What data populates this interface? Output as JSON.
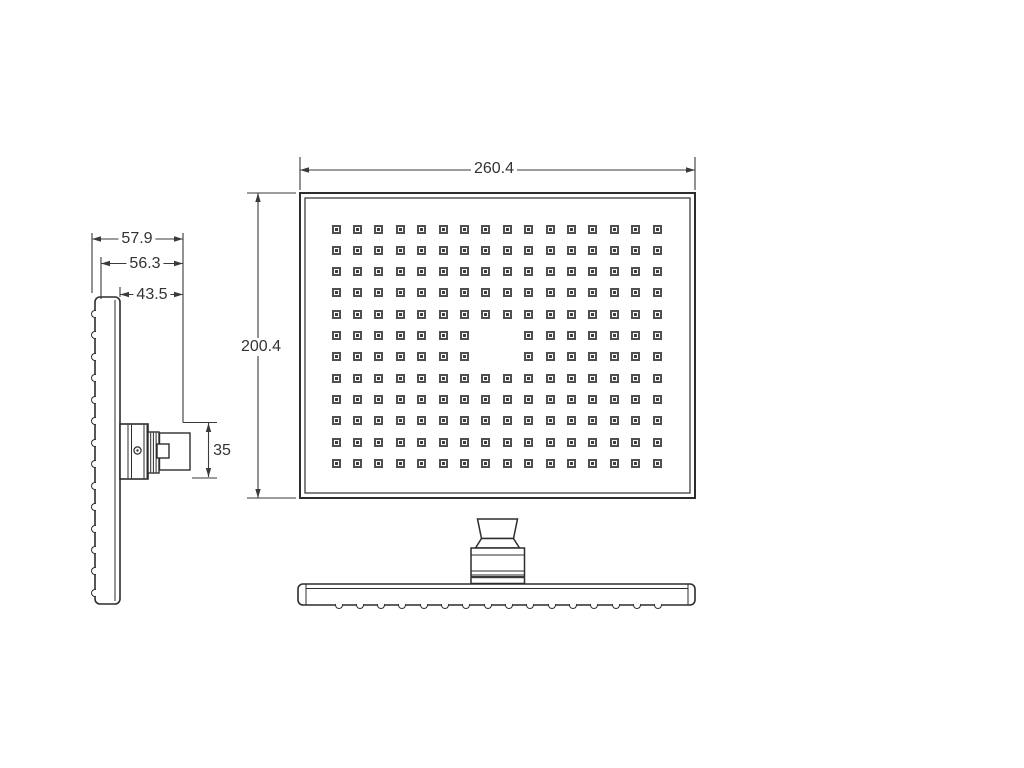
{
  "drawing": {
    "title": "shower-head-technical-drawing",
    "colors": {
      "background": "#ffffff",
      "outline": "#2d2d2d",
      "dimension": "#3a3a3a",
      "text": "#333333"
    },
    "dimensions": {
      "front_width": "260.4",
      "front_height": "200.4",
      "side_depth_total": "57.9",
      "side_depth_mid": "56.3",
      "side_depth_inner": "43.5",
      "connector_height": "35"
    },
    "front_view": {
      "nozzle_grid": {
        "cols": 16,
        "rows": 12,
        "missing_cells": [
          [
            5,
            7
          ],
          [
            5,
            8
          ],
          [
            6,
            7
          ],
          [
            6,
            8
          ]
        ]
      }
    },
    "side_view": {
      "nozzle_bump_count": 14
    },
    "bottom_view": {
      "nozzle_bump_count": 16
    }
  }
}
